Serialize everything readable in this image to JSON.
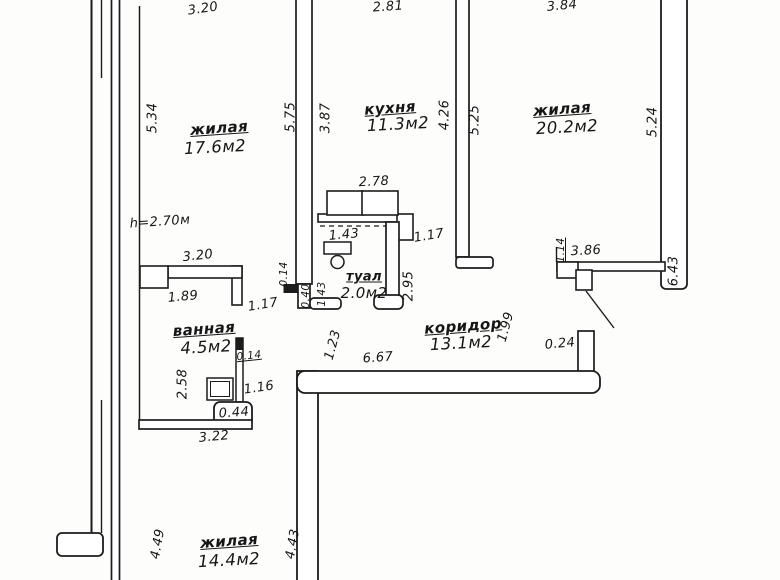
{
  "plan": {
    "height_note": "h=2.70м",
    "rooms": {
      "living1": {
        "name": "жилая",
        "area": "17.6м2"
      },
      "kitchen": {
        "name": "кухня",
        "area": "11.3м2"
      },
      "living2": {
        "name": "жилая",
        "area": "20.2м2"
      },
      "toilet": {
        "name": "туал",
        "area": "2.0м2"
      },
      "bath": {
        "name": "ванная",
        "area": "4.5м2"
      },
      "corridor": {
        "name": "коридор",
        "area": "13.1м2"
      },
      "living3": {
        "name": "жилая",
        "area": "14.4м2"
      }
    },
    "dims": {
      "top_living1": "3.20",
      "top_kitchen": "2.81",
      "top_living2": "3.84",
      "left_living1": "5.34",
      "right_living1": "5.75",
      "left_kitchen": "3.87",
      "right_kitchen": "4.26",
      "left_living2": "5.25",
      "right_living2": "5.24",
      "right_wall": "6.43",
      "hall_top": "3.20",
      "hall_189": "1.89",
      "hall_door": "1.17",
      "stub": "0.14",
      "counter": "2.78",
      "toilet_top": "1.43",
      "kitchen_door": "1.17",
      "toilet_wall": "0.40",
      "toilet_w": "1.43",
      "toilet_h": "2.95",
      "l2_offset": "1.14",
      "l2_bottom": "3.86",
      "pillar": "0.24",
      "corr_h": "1.99",
      "corr_len": "6.67",
      "corr_left": "1.23",
      "bath_wall": "0.14",
      "sink": "1.16",
      "bath_left": "2.58",
      "bath_pier": "0.44",
      "bath_bottom": "3.22",
      "left_living3": "4.49",
      "right_living3": "4.43"
    }
  }
}
